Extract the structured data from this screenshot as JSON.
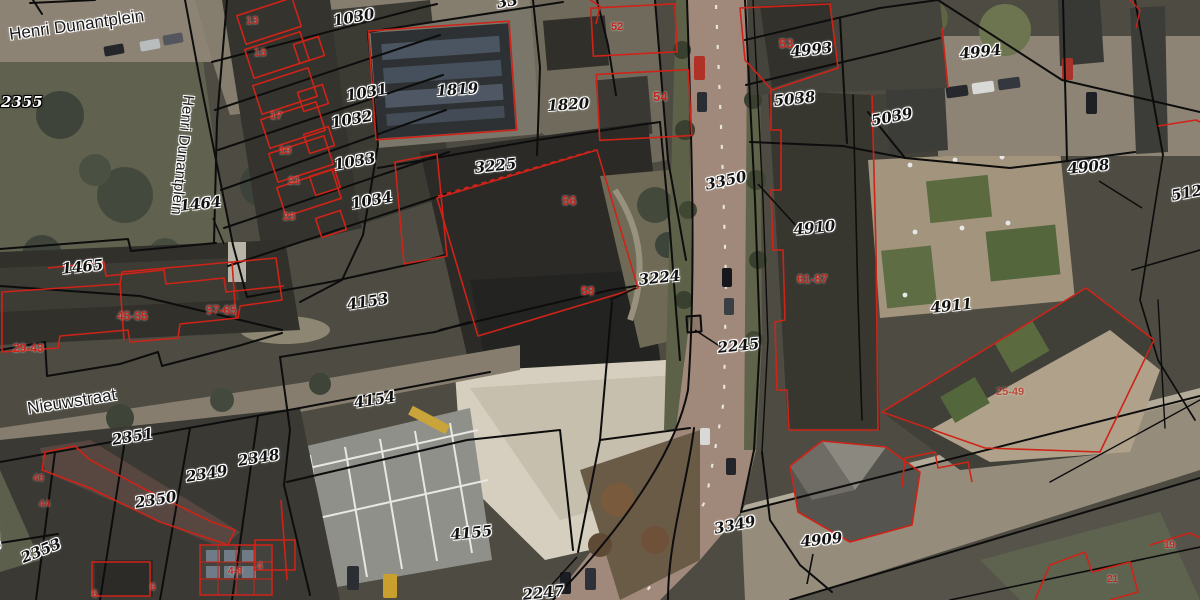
{
  "map": {
    "colors": {
      "parcel_line": "#0d0d0d",
      "building_outline": "#cf2318",
      "parcel_label": "#111111",
      "street_label": "#1b1b1b",
      "house_number": "#c1261b",
      "halo": "#ffffff"
    },
    "street_labels": [
      {
        "text": "Henri Dunantplein",
        "x": 8,
        "y": 26,
        "rot": -8,
        "size": 17
      },
      {
        "text": "Henri Dunantplein",
        "x": 196,
        "y": 96,
        "rot": 96,
        "size": 15
      },
      {
        "text": "Nieuwstraat",
        "x": 26,
        "y": 400,
        "rot": -9,
        "size": 17
      }
    ],
    "parcel_labels": [
      {
        "text": "2355",
        "x": 1,
        "y": 95,
        "rot": 0,
        "inverse": true
      },
      {
        "text": "33",
        "x": 496,
        "y": -4,
        "rot": -8
      },
      {
        "text": "1030",
        "x": 332,
        "y": 14,
        "rot": -10
      },
      {
        "text": "1031",
        "x": 345,
        "y": 89,
        "rot": -10
      },
      {
        "text": "1032",
        "x": 330,
        "y": 116,
        "rot": -10
      },
      {
        "text": "1033",
        "x": 333,
        "y": 158,
        "rot": -10
      },
      {
        "text": "1034",
        "x": 350,
        "y": 197,
        "rot": -10
      },
      {
        "text": "1819",
        "x": 436,
        "y": 84,
        "rot": -4
      },
      {
        "text": "1820",
        "x": 547,
        "y": 99,
        "rot": -4
      },
      {
        "text": "3225",
        "x": 474,
        "y": 161,
        "rot": -6
      },
      {
        "text": "3224",
        "x": 638,
        "y": 273,
        "rot": -6,
        "leader": [
          636,
          288,
          610,
          300
        ]
      },
      {
        "text": "3350",
        "x": 704,
        "y": 178,
        "rot": -12
      },
      {
        "text": "2245",
        "x": 717,
        "y": 341,
        "rot": -6,
        "leader": [
          721,
          347,
          695,
          330
        ]
      },
      {
        "text": "1464",
        "x": 179,
        "y": 199,
        "rot": -6,
        "leader": [
          213,
          218,
          224,
          244
        ]
      },
      {
        "text": "1465",
        "x": 61,
        "y": 262,
        "rot": -6
      },
      {
        "text": "4153",
        "x": 346,
        "y": 298,
        "rot": -9
      },
      {
        "text": "4154",
        "x": 353,
        "y": 396,
        "rot": -9
      },
      {
        "text": "4155",
        "x": 450,
        "y": 528,
        "rot": -6
      },
      {
        "text": "2351",
        "x": 111,
        "y": 433,
        "rot": -9
      },
      {
        "text": "2349",
        "x": 185,
        "y": 470,
        "rot": -9
      },
      {
        "text": "2350",
        "x": 134,
        "y": 496,
        "rot": -9
      },
      {
        "text": "2348",
        "x": 237,
        "y": 454,
        "rot": -9
      },
      {
        "text": "2352",
        "x": -4,
        "y": 508,
        "rot": 82
      },
      {
        "text": "2353",
        "x": 19,
        "y": 552,
        "rot": -22
      },
      {
        "text": "2247",
        "x": 522,
        "y": 588,
        "rot": -6,
        "leader": [
          547,
          590,
          577,
          557
        ]
      },
      {
        "text": "3349",
        "x": 713,
        "y": 522,
        "rot": -11
      },
      {
        "text": "4909",
        "x": 800,
        "y": 535,
        "rot": -6,
        "leader": [
          813,
          554,
          807,
          584
        ]
      },
      {
        "text": "4910",
        "x": 793,
        "y": 223,
        "rot": -6,
        "leader": [
          799,
          229,
          758,
          184
        ]
      },
      {
        "text": "4911",
        "x": 930,
        "y": 301,
        "rot": -6
      },
      {
        "text": "4908",
        "x": 1067,
        "y": 162,
        "rot": -6,
        "leader": [
          1099,
          181,
          1142,
          208
        ]
      },
      {
        "text": "5124",
        "x": 1170,
        "y": 189,
        "rot": -11
      },
      {
        "text": "4993",
        "x": 790,
        "y": 45,
        "rot": -6
      },
      {
        "text": "4994",
        "x": 959,
        "y": 47,
        "rot": -6
      },
      {
        "text": "5038",
        "x": 773,
        "y": 94,
        "rot": -6
      },
      {
        "text": "5039",
        "x": 870,
        "y": 114,
        "rot": -11
      }
    ],
    "house_numbers": [
      {
        "text": "13",
        "x": 246,
        "y": 16
      },
      {
        "text": "15",
        "x": 254,
        "y": 48
      },
      {
        "text": "17",
        "x": 270,
        "y": 111
      },
      {
        "text": "19",
        "x": 279,
        "y": 146
      },
      {
        "text": "21",
        "x": 288,
        "y": 176
      },
      {
        "text": "23",
        "x": 283,
        "y": 212
      },
      {
        "text": "52",
        "x": 611,
        "y": 22
      },
      {
        "text": "53",
        "x": 779,
        "y": 37,
        "size": 13
      },
      {
        "text": "54",
        "x": 653,
        "y": 90,
        "size": 13
      },
      {
        "text": "56",
        "x": 562,
        "y": 194,
        "size": 13
      },
      {
        "text": "58",
        "x": 581,
        "y": 285,
        "size": 12
      },
      {
        "text": "61-87",
        "x": 797,
        "y": 273,
        "size": 12
      },
      {
        "text": "29-43",
        "x": 13,
        "y": 342,
        "size": 12
      },
      {
        "text": "45-55",
        "x": 117,
        "y": 310,
        "size": 12
      },
      {
        "text": "57-65",
        "x": 206,
        "y": 304,
        "size": 12
      },
      {
        "text": "25-49",
        "x": 996,
        "y": 387,
        "size": 11,
        "opacity": 0.7
      },
      {
        "text": "46",
        "x": 33,
        "y": 474,
        "size": 10,
        "opacity": 0.85
      },
      {
        "text": "44",
        "x": 39,
        "y": 500,
        "size": 10,
        "opacity": 0.85
      },
      {
        "text": "4-8",
        "x": 228,
        "y": 567,
        "size": 10
      },
      {
        "text": "4",
        "x": 257,
        "y": 562,
        "size": 10
      },
      {
        "text": "6",
        "x": 150,
        "y": 583,
        "size": 10
      },
      {
        "text": "6",
        "x": 92,
        "y": 590,
        "size": 10
      },
      {
        "text": "21",
        "x": 1107,
        "y": 575,
        "size": 10
      },
      {
        "text": "19",
        "x": 1164,
        "y": 541,
        "size": 10
      }
    ]
  }
}
